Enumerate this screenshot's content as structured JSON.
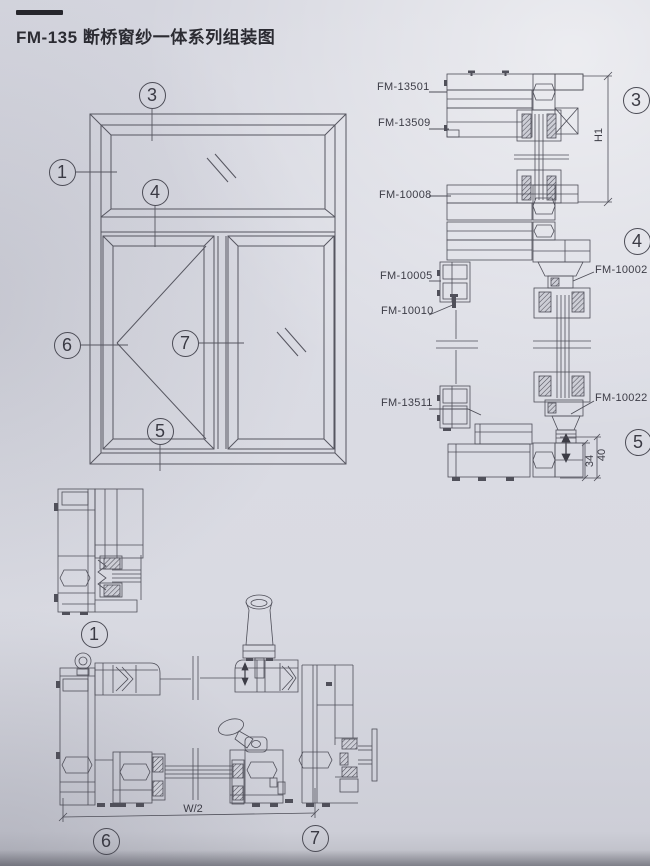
{
  "page": {
    "title": "FM-135 断桥窗纱一体系列组装图"
  },
  "callouts": {
    "c1": "1",
    "c3": "3",
    "c4": "4",
    "c5": "5",
    "c6": "6",
    "c7": "7"
  },
  "part_labels": {
    "fm13501": "FM-13501",
    "fm13509": "FM-13509",
    "fm10008": "FM-10008",
    "fm10005": "FM-10005",
    "fm10010": "FM-10010",
    "fm13511": "FM-13511",
    "fm10002": "FM-10002",
    "fm10022": "FM-10022"
  },
  "dimensions": {
    "h1": "H1",
    "d34": "34",
    "d40": "40",
    "w_half": "W/2"
  },
  "colors": {
    "paper": "#d9dae2",
    "line": "#53535d",
    "ink": "#2b2b32"
  }
}
